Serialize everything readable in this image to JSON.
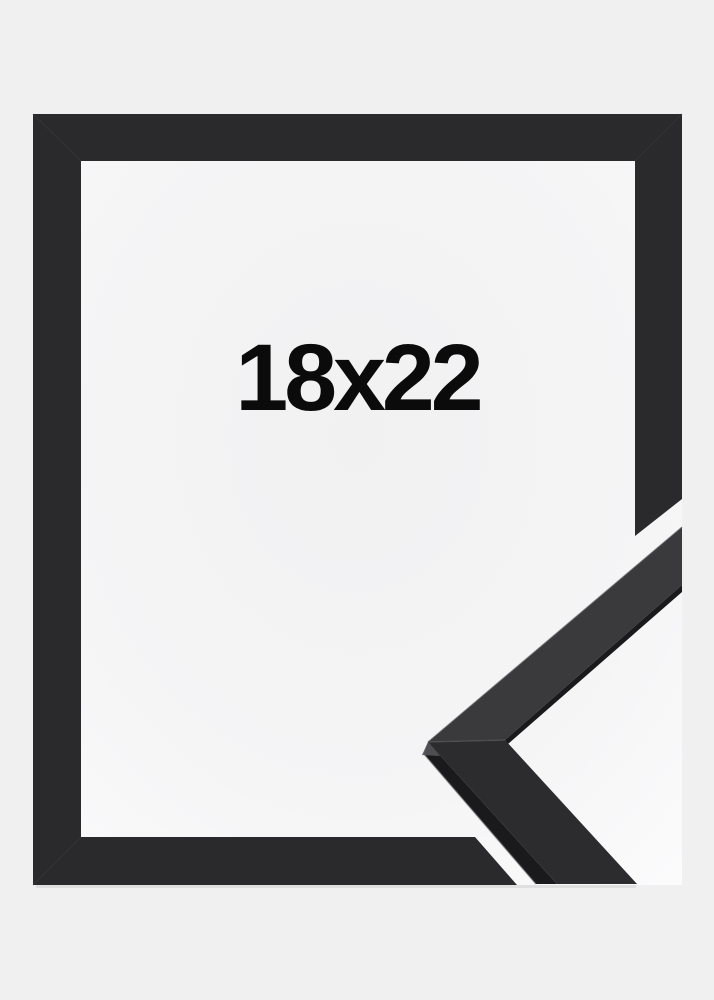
{
  "product": {
    "size_label": "18x22"
  },
  "colors": {
    "studio-background": "#f0f0f1",
    "backing-center": "#f1f1f2",
    "backing-mid": "#f5f5f6",
    "backing-edge": "#fcfcfd",
    "frame-front": "#2a2a2c",
    "seam": "#3a3a3c",
    "moulding-top-upper": "#3a3a3d",
    "moulding-top-lower": "#2c2c2f",
    "moulding-side": "#1a1a1c",
    "edge-highlight": "#55555a",
    "label-text": "#0b0b0b"
  }
}
